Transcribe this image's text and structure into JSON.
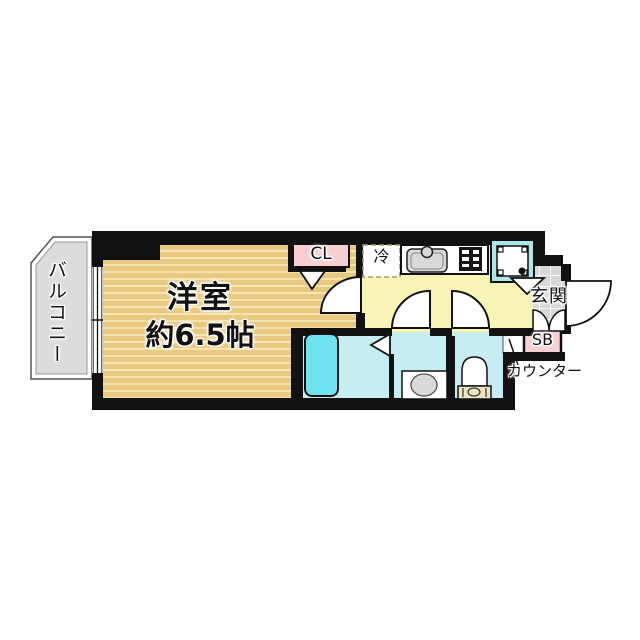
{
  "floorplan": {
    "balcony": {
      "label": "バルコニー"
    },
    "main_room": {
      "name": "洋室",
      "size": "約6.5帖"
    },
    "closet": {
      "label": "CL"
    },
    "refrigerator": {
      "label": "冷"
    },
    "entrance": {
      "label": "玄関"
    },
    "shoe_box": {
      "label": "SB"
    },
    "counter": {
      "label": "カウンター"
    },
    "colors": {
      "wall": "#111111",
      "room_floor": "#e9c87f",
      "room_stripe": "#f4e5b0",
      "balcony_gray": "#dcdcdc",
      "kitchen_yellow": "#f7f4b5",
      "water_blue": "#c6edf2",
      "bathtub_blue": "#6fe3ef",
      "pink": "#f8d0d4",
      "tile_gray": "#d8d8d8",
      "pan_blue": "#aee6ea",
      "fixture_gray": "#d9d9d9",
      "tank_beige": "#ece4c2"
    }
  }
}
